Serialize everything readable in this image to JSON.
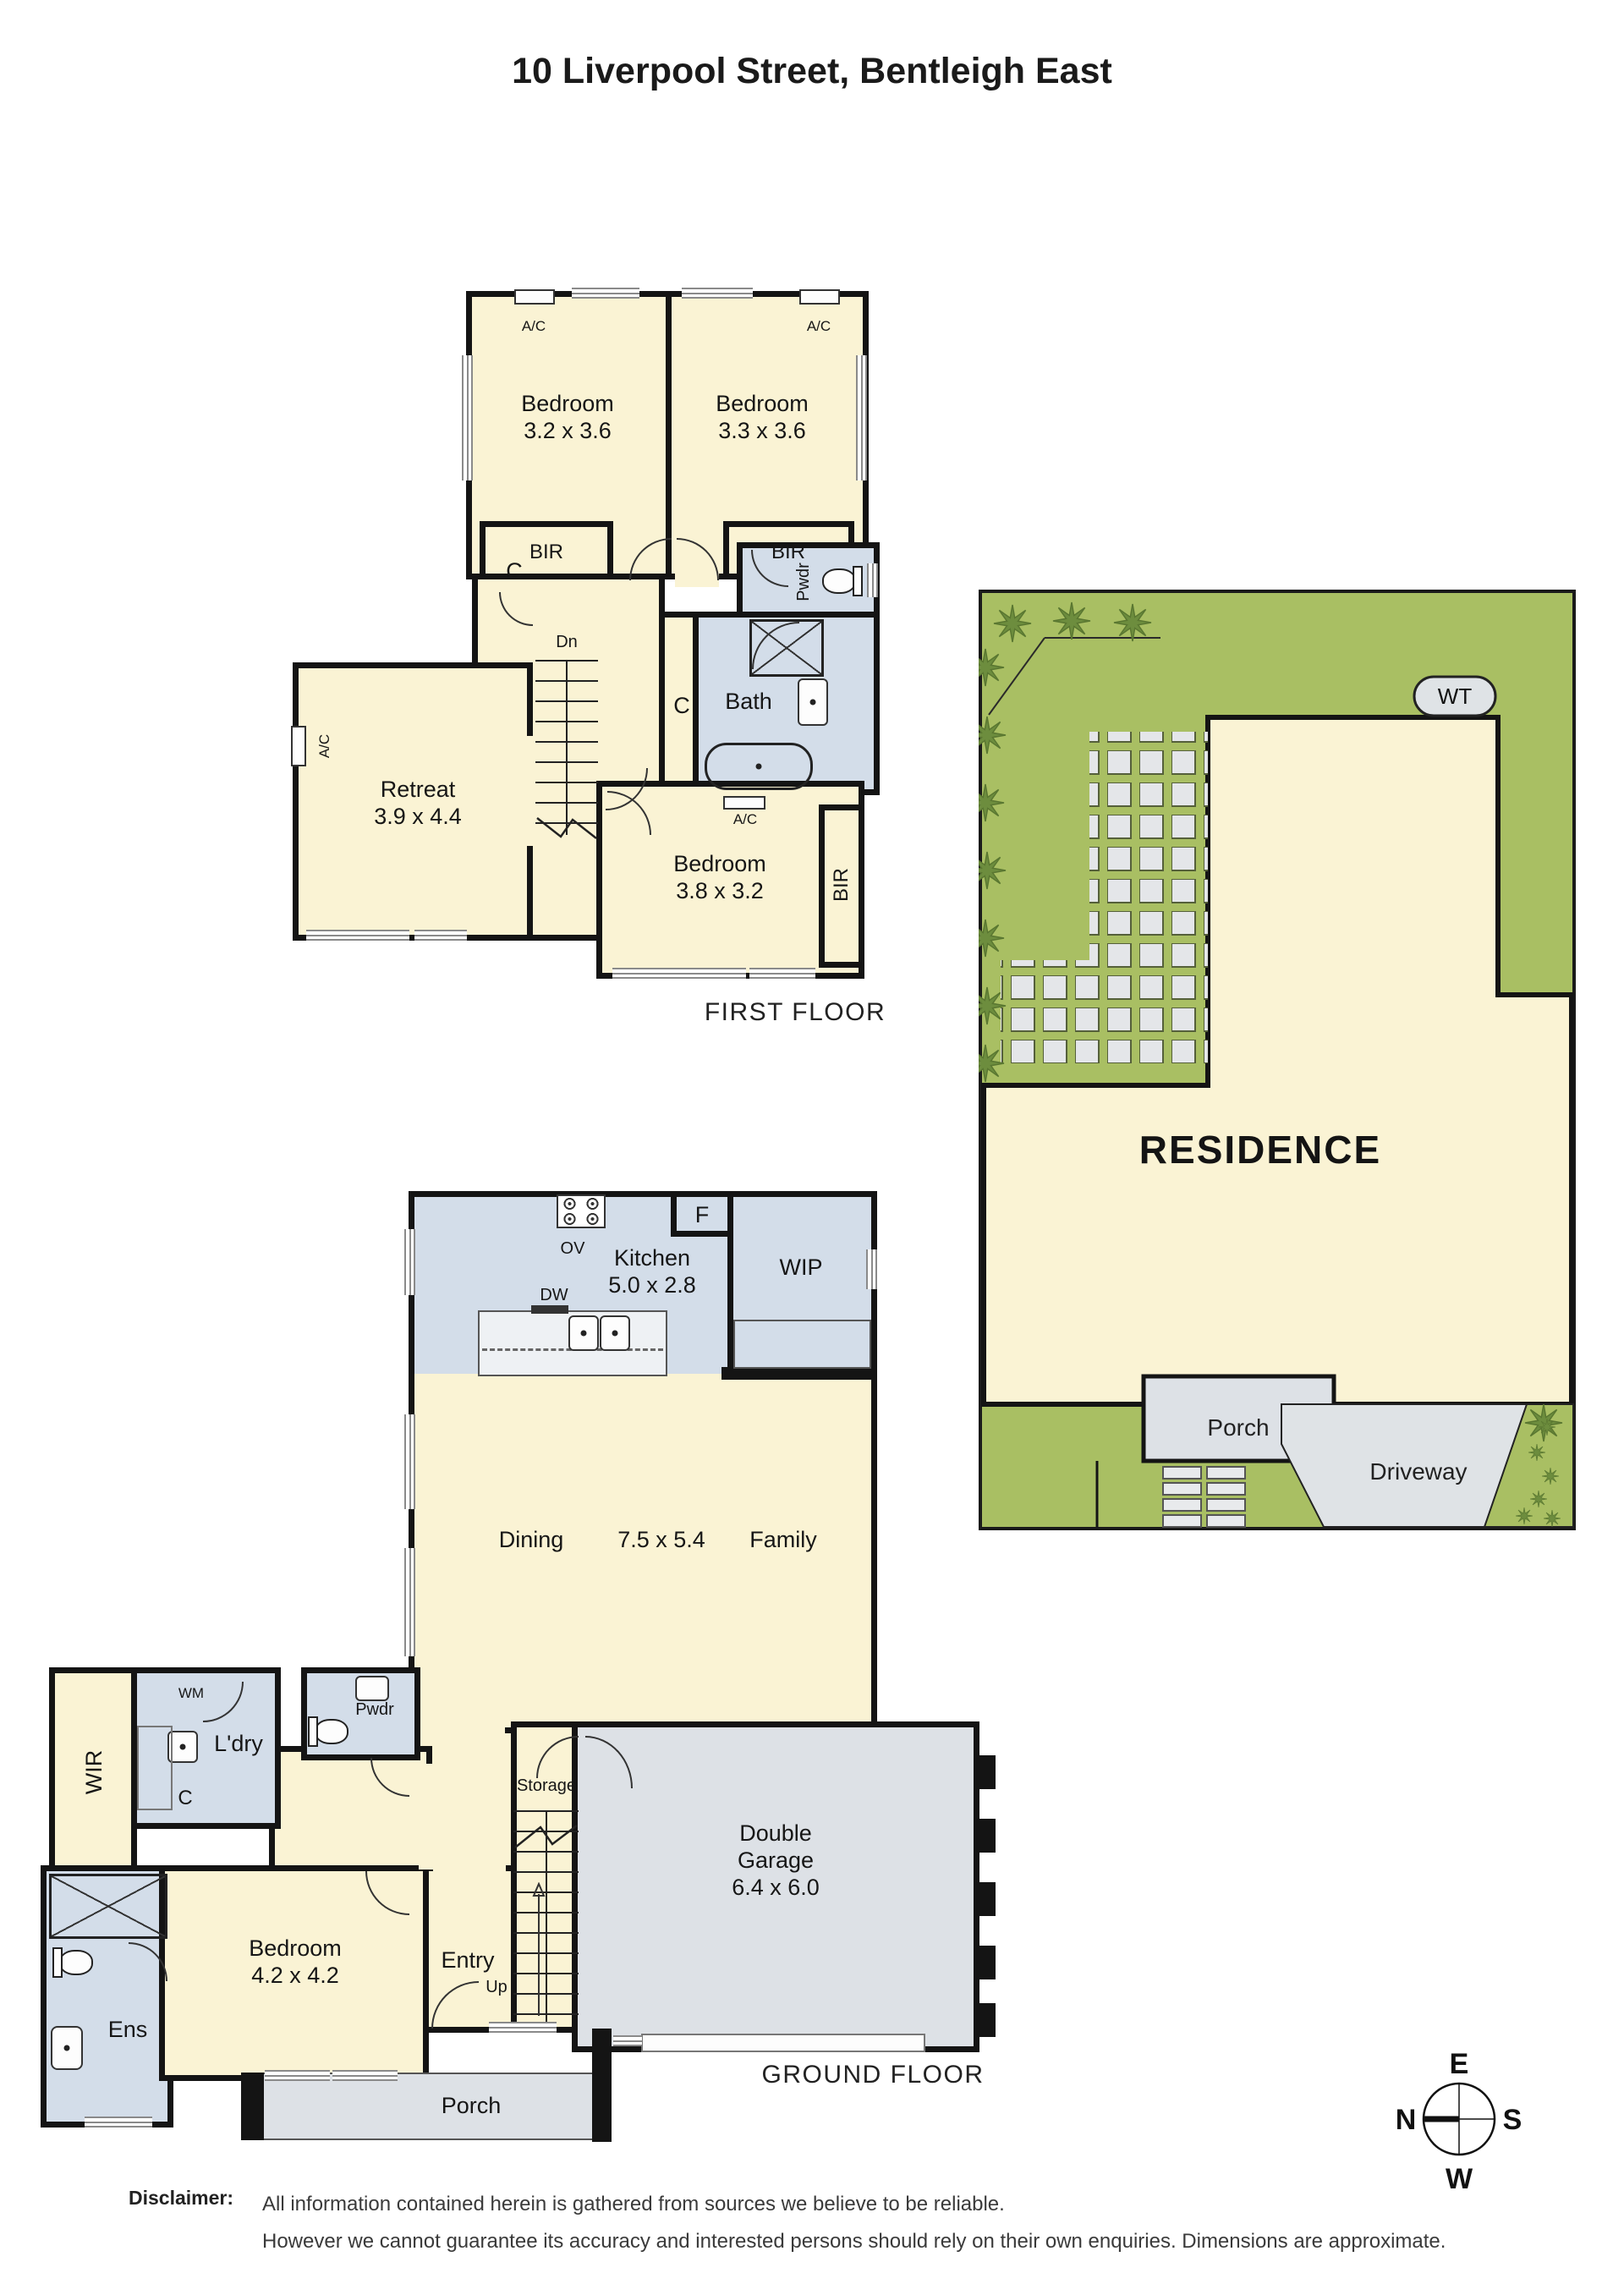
{
  "title": "10 Liverpool Street, Bentleigh East",
  "colors": {
    "room_cream": "#faf3d4",
    "wet_area_blue": "#d3dde9",
    "hard_surface_gray": "#dde1e6",
    "site_green": "#a9bf63",
    "tree_green": "#6d8d3e",
    "wall_black": "#141414"
  },
  "first_floor": {
    "caption": "FIRST FLOOR",
    "bedroom1": {
      "name": "Bedroom",
      "dims": "3.2 x 3.6"
    },
    "bedroom2": {
      "name": "Bedroom",
      "dims": "3.3 x 3.6"
    },
    "bedroom3": {
      "name": "Bedroom",
      "dims": "3.8 x 3.2"
    },
    "retreat": {
      "name": "Retreat",
      "dims": "3.9 x 4.4"
    },
    "bath": "Bath",
    "pwdr": "Pwdr",
    "bir": "BIR",
    "closet": "C",
    "stairs_down": "Dn",
    "ac": "A/C"
  },
  "ground_floor": {
    "caption": "GROUND FLOOR",
    "kitchen": {
      "name": "Kitchen",
      "dims": "5.0 x 2.8"
    },
    "wip": "WIP",
    "fridge": "F",
    "oven": "OV",
    "dishwasher": "DW",
    "dining": "Dining",
    "living_dims": "7.5 x 5.4",
    "family": "Family",
    "laundry": "L'dry",
    "washing_machine": "WM",
    "closet": "C",
    "wir": "WIR",
    "pwdr": "Pwdr",
    "ens": "Ens",
    "bedroom": {
      "name": "Bedroom",
      "dims": "4.2 x 4.2"
    },
    "entry": "Entry",
    "up": "Up",
    "storage": "Storage",
    "garage": {
      "line1": "Double",
      "line2": "Garage",
      "dims": "6.4 x 6.0"
    },
    "porch": "Porch"
  },
  "site_plan": {
    "residence": "RESIDENCE",
    "porch": "Porch",
    "driveway": "Driveway",
    "water_tank": "WT"
  },
  "compass": {
    "north": "N",
    "south": "S",
    "east": "E",
    "west": "W"
  },
  "disclaimer": {
    "label": "Disclaimer:",
    "line1": "All information contained herein is gathered from sources we believe to be reliable.",
    "line2": "However we cannot guarantee its accuracy and interested persons should rely on their own enquiries. Dimensions are approximate."
  }
}
